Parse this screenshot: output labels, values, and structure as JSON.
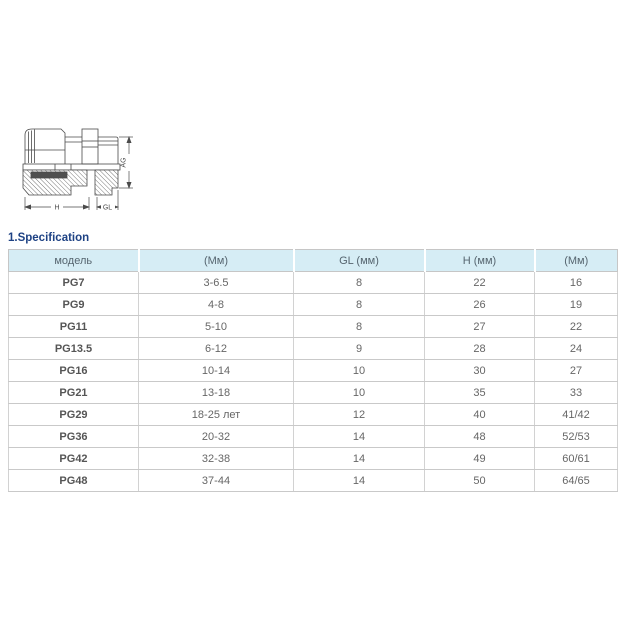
{
  "section_title": "1.Specification",
  "diagram": {
    "description": "cable-gland-cross-section",
    "labels": {
      "h": "H",
      "gl": "GL",
      "ag": "AG"
    }
  },
  "table": {
    "headers": [
      "модель",
      "(Мм)",
      "GL (мм)",
      "H (мм)",
      "(Мм)"
    ],
    "rows": [
      [
        "PG7",
        "3-6.5",
        "8",
        "22",
        "16"
      ],
      [
        "PG9",
        "4-8",
        "8",
        "26",
        "19"
      ],
      [
        "PG11",
        "5-10",
        "8",
        "27",
        "22"
      ],
      [
        "PG13.5",
        "6-12",
        "9",
        "28",
        "24"
      ],
      [
        "PG16",
        "10-14",
        "10",
        "30",
        "27"
      ],
      [
        "PG21",
        "13-18",
        "10",
        "35",
        "33"
      ],
      [
        "PG29",
        "18-25 лет",
        "12",
        "40",
        "41/42"
      ],
      [
        "PG36",
        "20-32",
        "14",
        "48",
        "52/53"
      ],
      [
        "PG42",
        "32-38",
        "14",
        "49",
        "60/61"
      ],
      [
        "PG48",
        "37-44",
        "14",
        "50",
        "64/65"
      ]
    ]
  },
  "colors": {
    "header_bg": "#d6edf5",
    "table_border": "#c9c9c9",
    "title_color": "#1e4284",
    "body_text": "#666666",
    "diagram_line": "#4a4a4a"
  }
}
